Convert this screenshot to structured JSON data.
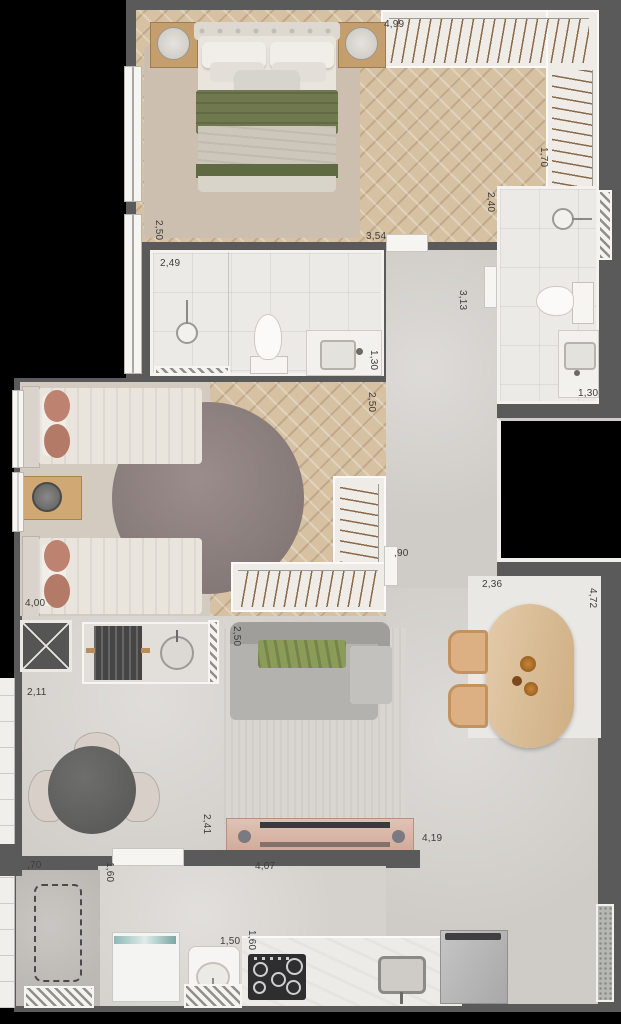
{
  "plan": {
    "type": "apartment-floor-plan",
    "dimensions": [
      {
        "text": "4,99",
        "x": 384,
        "y": 19,
        "vertical": false
      },
      {
        "text": "1,70",
        "x": 538,
        "y": 147,
        "vertical": true
      },
      {
        "text": "2,40",
        "x": 485,
        "y": 192,
        "vertical": true
      },
      {
        "text": "2,50",
        "x": 153,
        "y": 220,
        "vertical": true
      },
      {
        "text": "3,54",
        "x": 366,
        "y": 231,
        "vertical": false
      },
      {
        "text": "2,49",
        "x": 160,
        "y": 258,
        "vertical": false
      },
      {
        "text": "3,13",
        "x": 457,
        "y": 290,
        "vertical": true
      },
      {
        "text": "1,30",
        "x": 368,
        "y": 350,
        "vertical": true
      },
      {
        "text": "1,30",
        "x": 578,
        "y": 388,
        "vertical": false
      },
      {
        "text": "2,50",
        "x": 366,
        "y": 392,
        "vertical": true
      },
      {
        "text": ",90",
        "x": 394,
        "y": 548,
        "vertical": false
      },
      {
        "text": "4,00",
        "x": 25,
        "y": 598,
        "vertical": false
      },
      {
        "text": "2,36",
        "x": 482,
        "y": 579,
        "vertical": false
      },
      {
        "text": "4,72",
        "x": 587,
        "y": 588,
        "vertical": true
      },
      {
        "text": "2,50",
        "x": 231,
        "y": 626,
        "vertical": true
      },
      {
        "text": "2,11",
        "x": 27,
        "y": 687,
        "vertical": false
      },
      {
        "text": "2,41",
        "x": 201,
        "y": 814,
        "vertical": true
      },
      {
        "text": "4,19",
        "x": 422,
        "y": 833,
        "vertical": false
      },
      {
        "text": "4,07",
        "x": 255,
        "y": 861,
        "vertical": false
      },
      {
        "text": ",70",
        "x": 27,
        "y": 860,
        "vertical": false
      },
      {
        "text": "1,60",
        "x": 104,
        "y": 862,
        "vertical": true
      },
      {
        "text": "1,50",
        "x": 220,
        "y": 936,
        "vertical": false
      },
      {
        "text": "1,60",
        "x": 246,
        "y": 930,
        "vertical": true
      }
    ],
    "colors": {
      "wall": "#5a5a5a",
      "void": "#000000",
      "wood_floor": "#d6c1a3",
      "tile": "#eceae6",
      "concrete": "#cfccc7",
      "rug_beige": "#cdbfb0",
      "rug_round": "#8d8080",
      "duvet_green": "#6f784e",
      "throw_green": "#8b9b58",
      "rattan": "#dcb083",
      "table_wood": "#d9c09e",
      "cushion_salmon": "#bd8270",
      "label": "#3f3d3a"
    }
  }
}
